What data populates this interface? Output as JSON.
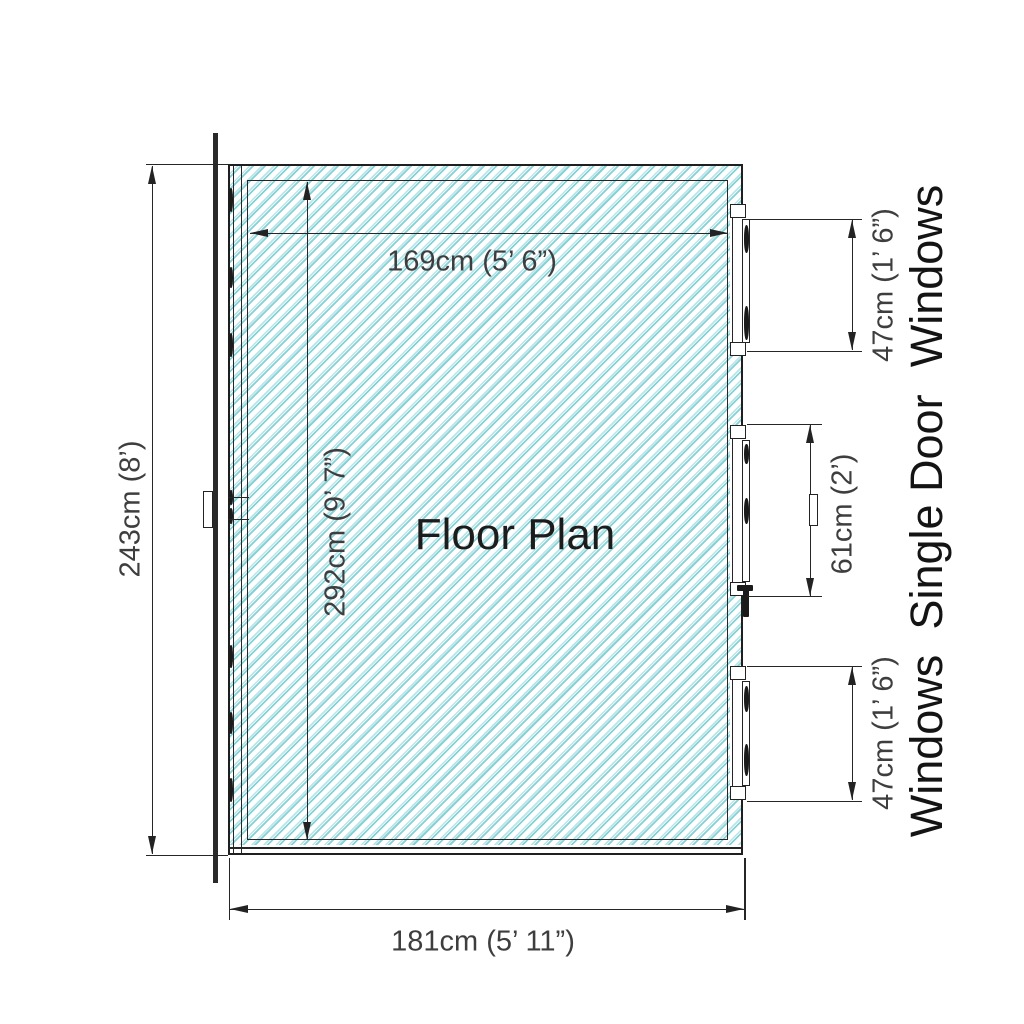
{
  "title": "Floor Plan",
  "colors": {
    "background": "#ffffff",
    "hatch_light": "#b9e5e8",
    "hatch_dark": "#84d1d6",
    "line": "#232323",
    "dimension_text": "#3e3e3e",
    "label_text": "#141414"
  },
  "dimensions": {
    "outer_height": "243cm (8’)",
    "inner_width": "169cm (5’ 6”)",
    "inner_height": "292cm (9’ 7”)",
    "outer_width": "181cm (5’ 11”)",
    "window_top": "47cm (1’ 6”)",
    "door_width": "61cm (2’)",
    "window_bottom": "47cm (1’ 6”)"
  },
  "side_labels": {
    "windows_top": "Windows",
    "single_door": "Single Door",
    "windows_bottom": "Windows"
  }
}
